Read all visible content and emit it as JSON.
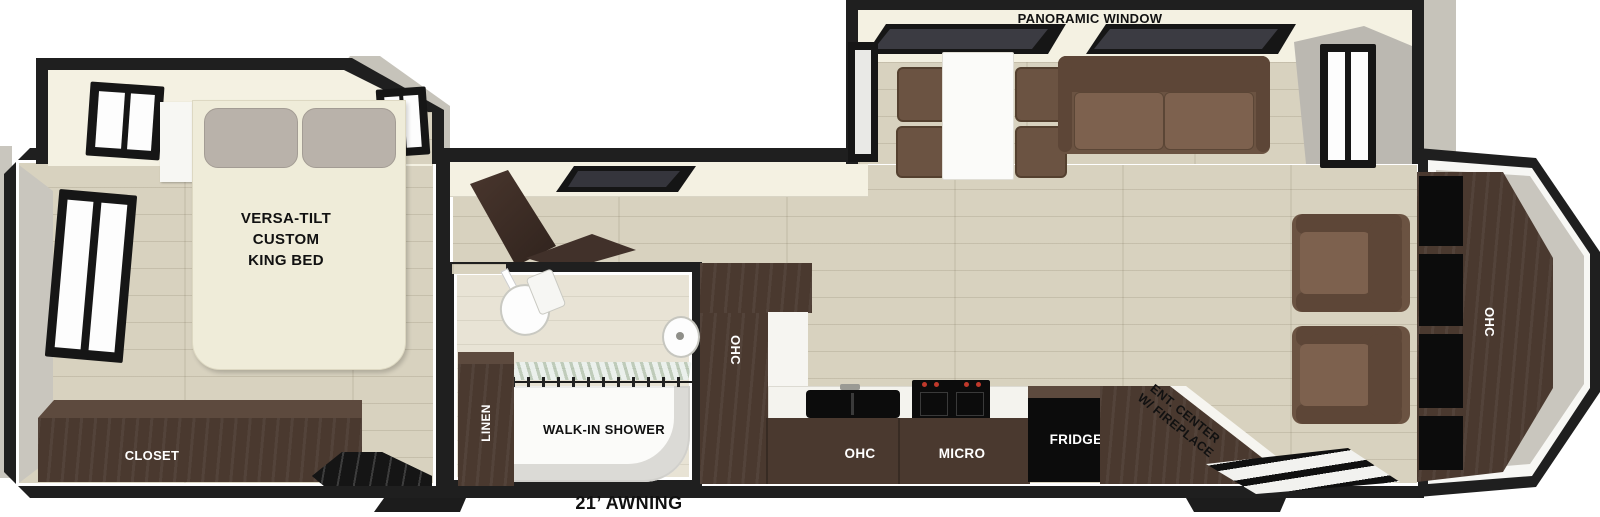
{
  "title": "Travel trailer floorplan",
  "labels": {
    "panoramic_window": "PANORAMIC WINDOW",
    "bed_line1": "VERSA-TILT",
    "bed_line2": "CUSTOM",
    "bed_line3": "KING BED",
    "closet": "CLOSET",
    "linen": "LINEN",
    "walk_in_shower": "WALK-IN SHOWER",
    "pantry_ohc": "OHC",
    "kitchen_ohc": "OHC",
    "micro": "MICRO",
    "fridge": "FRIDGE",
    "ent_center_line1": "ENT. CENTER",
    "ent_center_line2": "W/ FIREPLACE",
    "rear_ohc": "OHC",
    "awning": "21’ AWNING"
  },
  "colors": {
    "wall": "#1f1f1f",
    "wood_floor": "#d8d2bf",
    "bathroom_floor": "#e8e3d5",
    "dark_wood_cabinet": "#4a392f",
    "upholstery_brown": "#6b5342",
    "slide_interior_cream": "#f4f1e2",
    "bed_cream": "#efecd9",
    "appliance_black": "#0c0c0c",
    "stove_knob_red": "#c0392b",
    "exterior_gray": "#c9c6be"
  }
}
